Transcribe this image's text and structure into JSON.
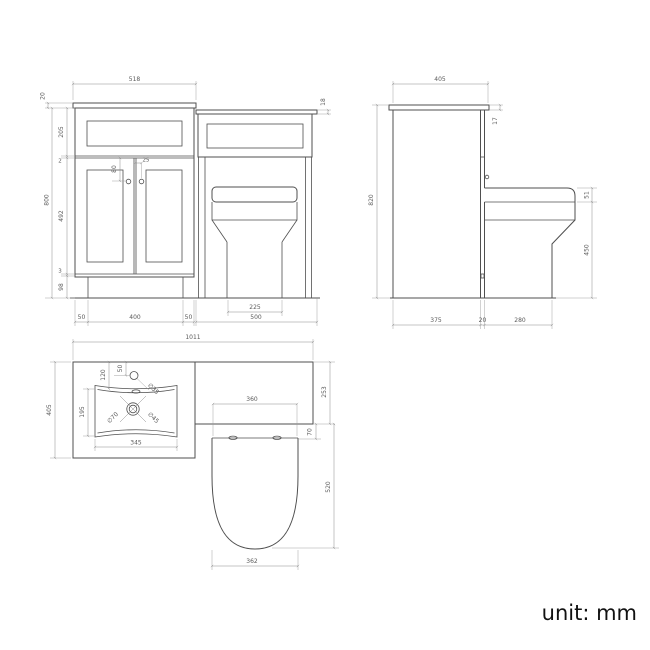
{
  "unit_label": "unit: mm",
  "colors": {
    "line": "#4f4f4f",
    "dim_line": "#8a8a8a",
    "dim_text": "#5a5a5a",
    "background": "#ffffff"
  },
  "front_view": {
    "title": "front-elevation",
    "dims": {
      "vanity_worktop_width": "518",
      "vanity_worktop_thickness": "20",
      "wc_worktop_thickness": "18",
      "drawer_front_height": "205",
      "top_gap": "2",
      "door_height": "492",
      "bottom_gap": "3",
      "plinth_height": "98",
      "carcass_height": "800",
      "handle_drop": "80",
      "handle_offset": "25",
      "plinth_left_inset": "50",
      "plinth_length": "400",
      "plinth_right_inset": "50",
      "wc_unit_width": "500",
      "pan_base_width": "225"
    }
  },
  "side_view": {
    "title": "side-elevation",
    "dims": {
      "worktop_depth": "405",
      "worktop_thickness": "17",
      "overall_height": "820",
      "seat_thickness": "51",
      "pan_height": "450",
      "cabinet_depth": "375",
      "gap": "20",
      "pan_projection": "280"
    }
  },
  "plan_view": {
    "title": "plan-view",
    "dims": {
      "overall_width": "1011",
      "vanity_depth": "405",
      "tap_hole_setback": "120",
      "tap_hole_edge_offset": "50",
      "tap_hole_diameter": "∅35",
      "basin_bowl_depth": "195",
      "basin_bowl_width": "345",
      "waste_outer_diameter": "∅70",
      "waste_inner_diameter": "∅45",
      "seat_top_width": "360",
      "wc_unit_depth": "253",
      "seat_setback": "70",
      "seat_length": "520",
      "seat_width": "362"
    }
  }
}
